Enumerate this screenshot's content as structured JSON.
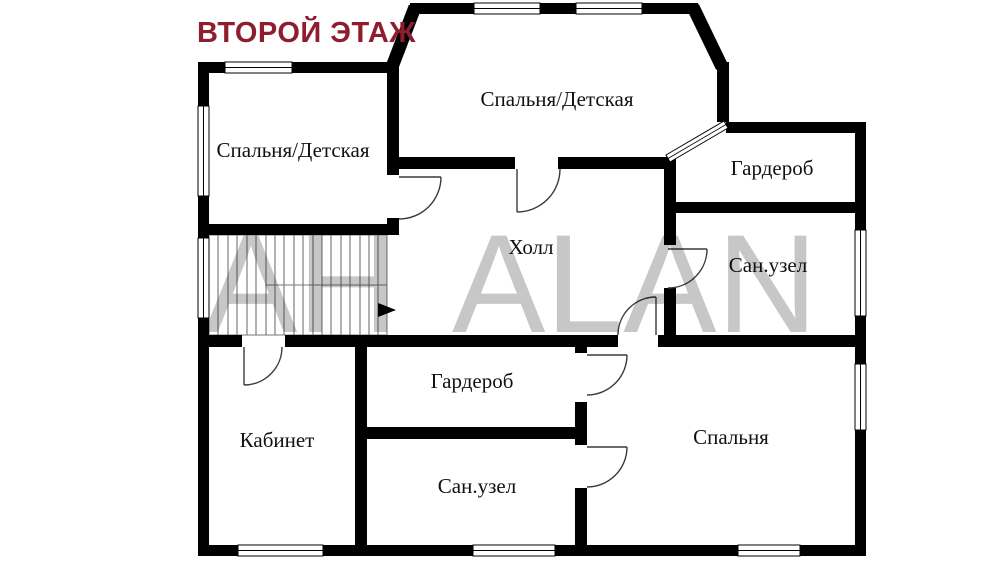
{
  "title": {
    "text": "ВТОРОЙ ЭТАЖ",
    "color": "#8e1e2f"
  },
  "watermark": {
    "part1": "АН",
    "part2": "ALAN",
    "color": "#c7c7c7"
  },
  "rooms": [
    {
      "id": "bedroom-left",
      "label": "Спальня/Детская"
    },
    {
      "id": "bedroom-top",
      "label": "Спальня/Детская"
    },
    {
      "id": "wardrobe-top-right",
      "label": "Гардероб"
    },
    {
      "id": "bathroom-top-right",
      "label": "Сан.узел"
    },
    {
      "id": "hall",
      "label": "Холл"
    },
    {
      "id": "wardrobe-bottom",
      "label": "Гардероб"
    },
    {
      "id": "bathroom-bottom",
      "label": "Сан.узел"
    },
    {
      "id": "office",
      "label": "Кабинет"
    },
    {
      "id": "bedroom-main",
      "label": "Спальня"
    }
  ],
  "colors": {
    "wall": "#000000",
    "background": "#ffffff"
  }
}
